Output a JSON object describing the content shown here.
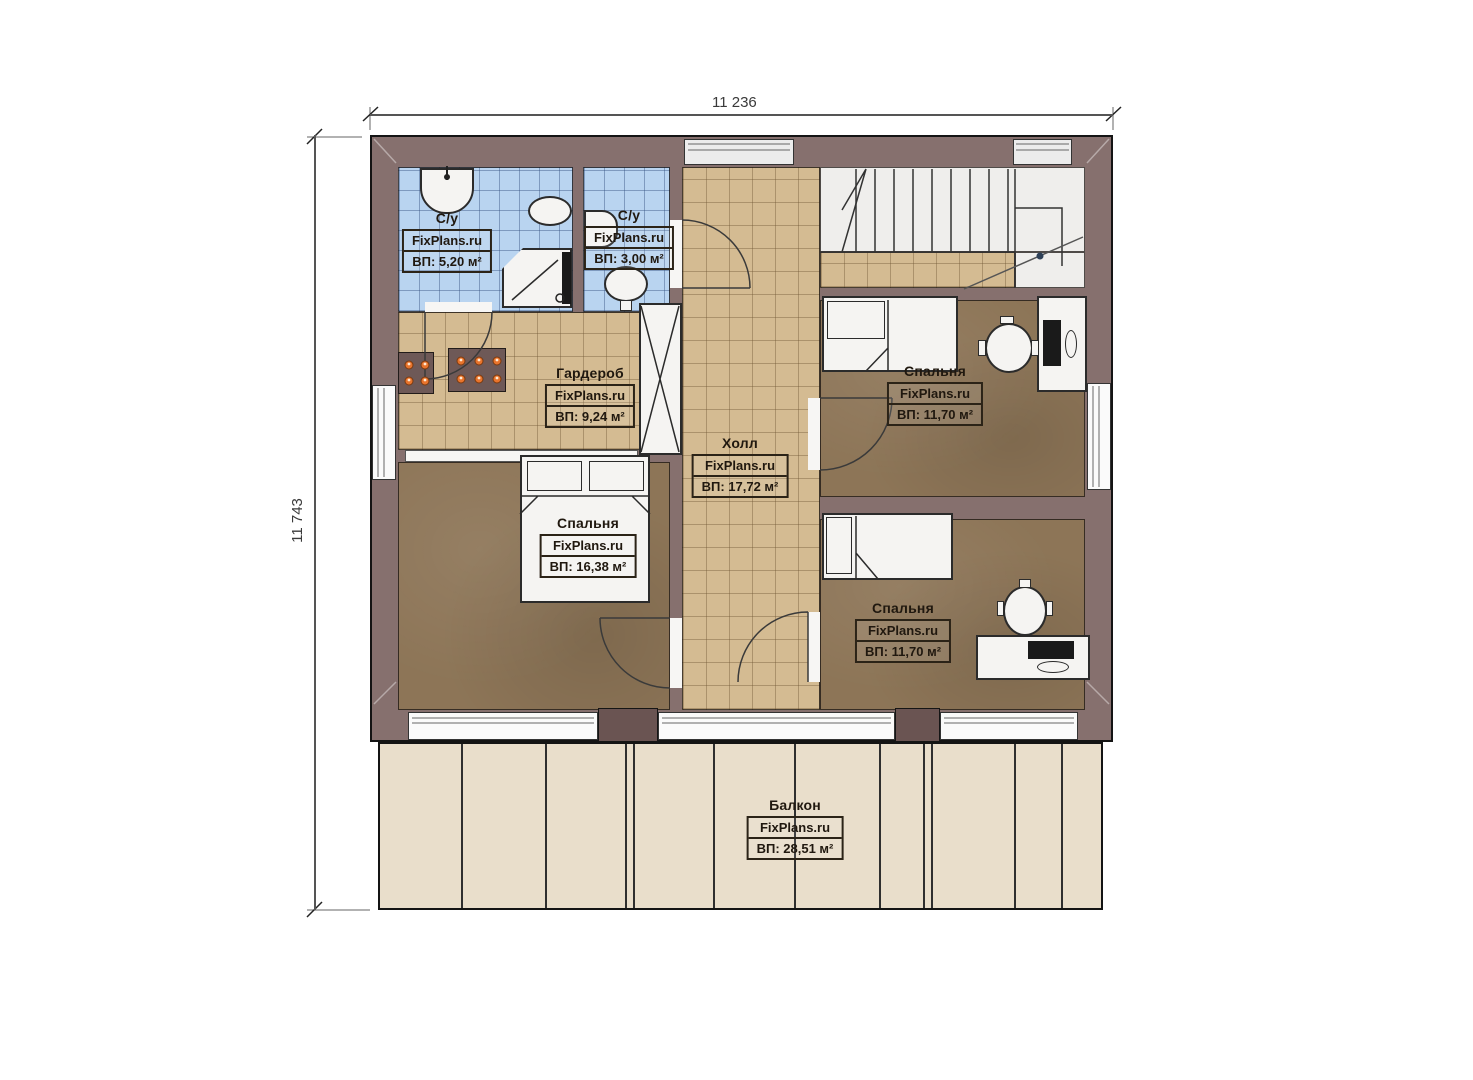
{
  "dimensions": {
    "top": "11 236",
    "left": "11 743"
  },
  "rooms": [
    {
      "key": "bathroom-large",
      "name": "С/у",
      "watermark": "FixPlans.ru",
      "area": "ВП: 5,20 м²"
    },
    {
      "key": "bathroom-small",
      "name": "С/у",
      "watermark": "FixPlans.ru",
      "area": "ВП: 3,00 м²"
    },
    {
      "key": "wardrobe",
      "name": "Гардероб",
      "watermark": "FixPlans.ru",
      "area": "ВП: 9,24 м²"
    },
    {
      "key": "hall",
      "name": "Холл",
      "watermark": "FixPlans.ru",
      "area": "ВП: 17,72 м²"
    },
    {
      "key": "bedroom-top-right",
      "name": "Спальня",
      "watermark": "FixPlans.ru",
      "area": "ВП: 11,70 м²"
    },
    {
      "key": "bedroom-master",
      "name": "Спальня",
      "watermark": "FixPlans.ru",
      "area": "ВП: 16,38 м²"
    },
    {
      "key": "bedroom-bottom-right",
      "name": "Спальня",
      "watermark": "FixPlans.ru",
      "area": "ВП: 11,70 м²"
    },
    {
      "key": "balcony",
      "name": "Балкон",
      "watermark": "FixPlans.ru",
      "area": "ВП: 28,51 м²"
    }
  ],
  "colors": {
    "wall": "#86706e",
    "bathroom_floor": "#b9d4f0",
    "tile_floor": "#d4bb92",
    "bedroom_floor": "#8d7557",
    "balcony_floor": "#e9decb"
  }
}
